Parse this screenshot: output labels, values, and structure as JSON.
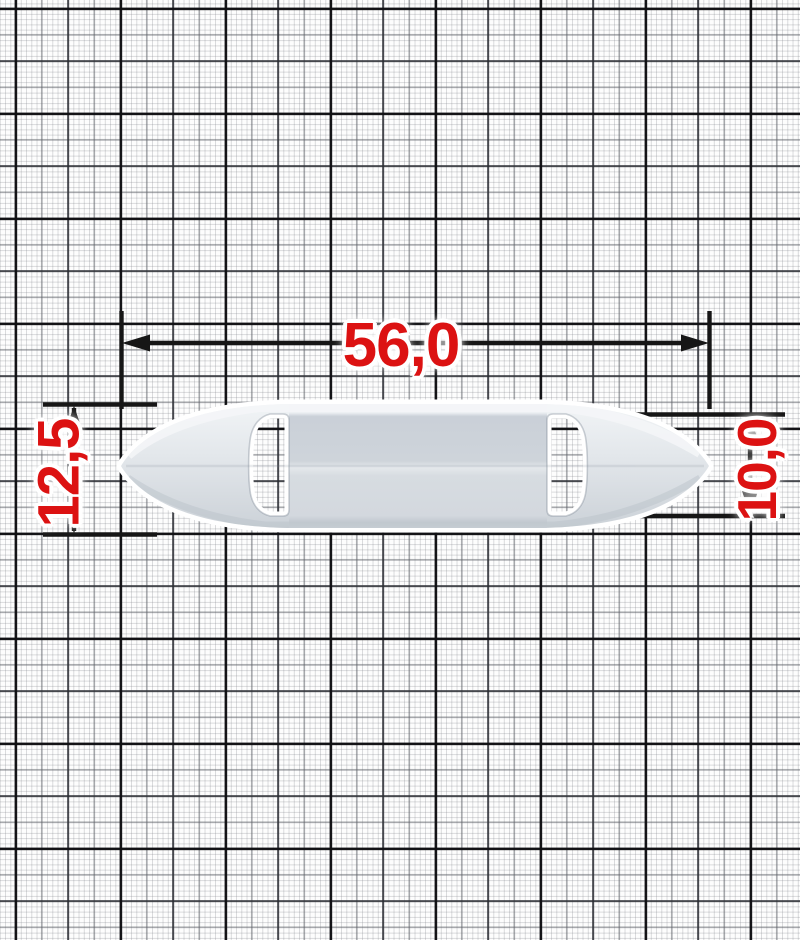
{
  "drawing": {
    "kind": "technical dimension drawing of a stamped slider buckle on millimeter graph paper",
    "dimensions": {
      "width": {
        "value": "56,0"
      },
      "height_overall": {
        "value": "12,5"
      },
      "height_tip": {
        "value": "10,0"
      }
    },
    "icons": [
      "arrow-left-icon",
      "arrow-right-icon",
      "arrow-up-icon",
      "arrow-down-icon"
    ],
    "colors": {
      "dimension_text": "#dc1212",
      "dimension_line": "#161616",
      "grid_heavy": "#17171a",
      "grid_fine": "#d9dade",
      "part_fill_light": "#eef1f4",
      "part_fill_mid": "#d9dee3",
      "part_fill_dark": "#c9cfd7"
    }
  }
}
